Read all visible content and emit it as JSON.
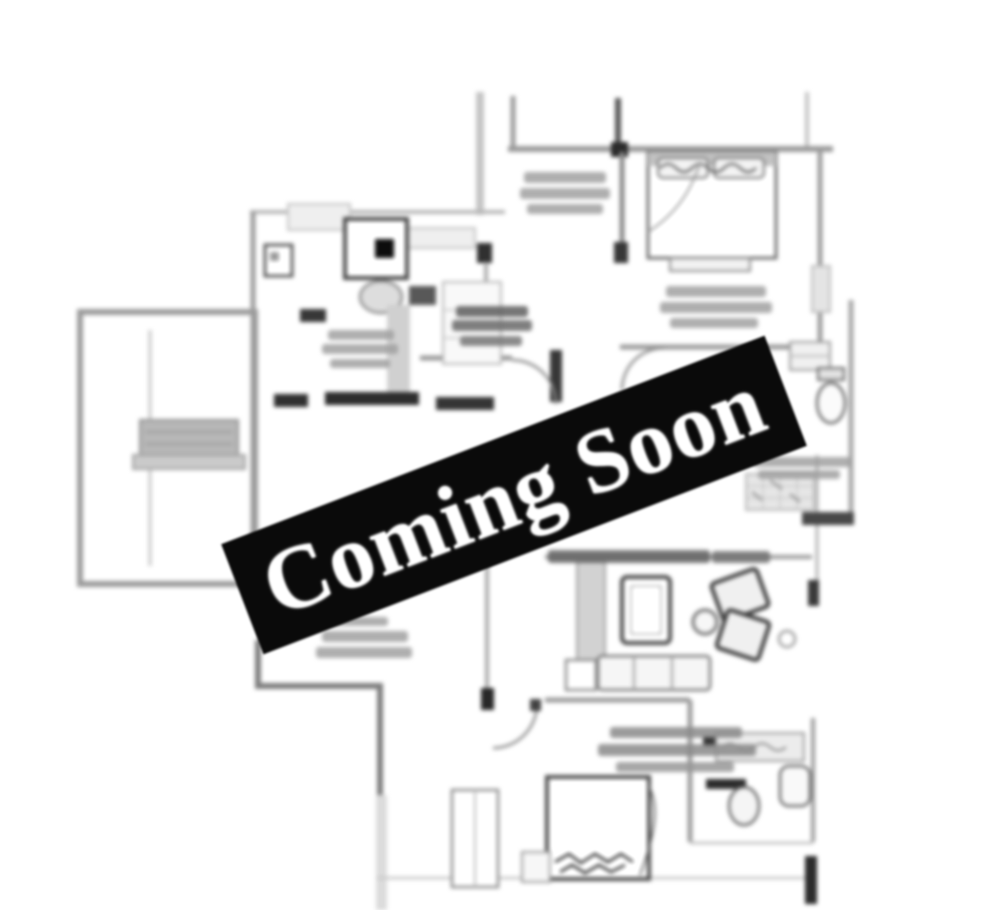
{
  "banner": {
    "text": "Coming Soon",
    "background_color": "#0a0a0a",
    "text_color": "#ffffff",
    "rotation_deg": -21
  },
  "canvas": {
    "background_color": "#ffffff",
    "width_px": 1000,
    "height_px": 910,
    "style": "blurred monochrome architectural floor plan"
  },
  "floor_plan": {
    "line_color": "#8f8f8f",
    "accent_color": "#2e2e2e",
    "labels_legible": false,
    "regions": [
      "bedroom-top-right",
      "kitchen-top-left",
      "balcony-left",
      "toilet-right",
      "living-dining-center",
      "bedroom-bottom-center",
      "toilet-bottom-right",
      "foyer-center"
    ]
  }
}
